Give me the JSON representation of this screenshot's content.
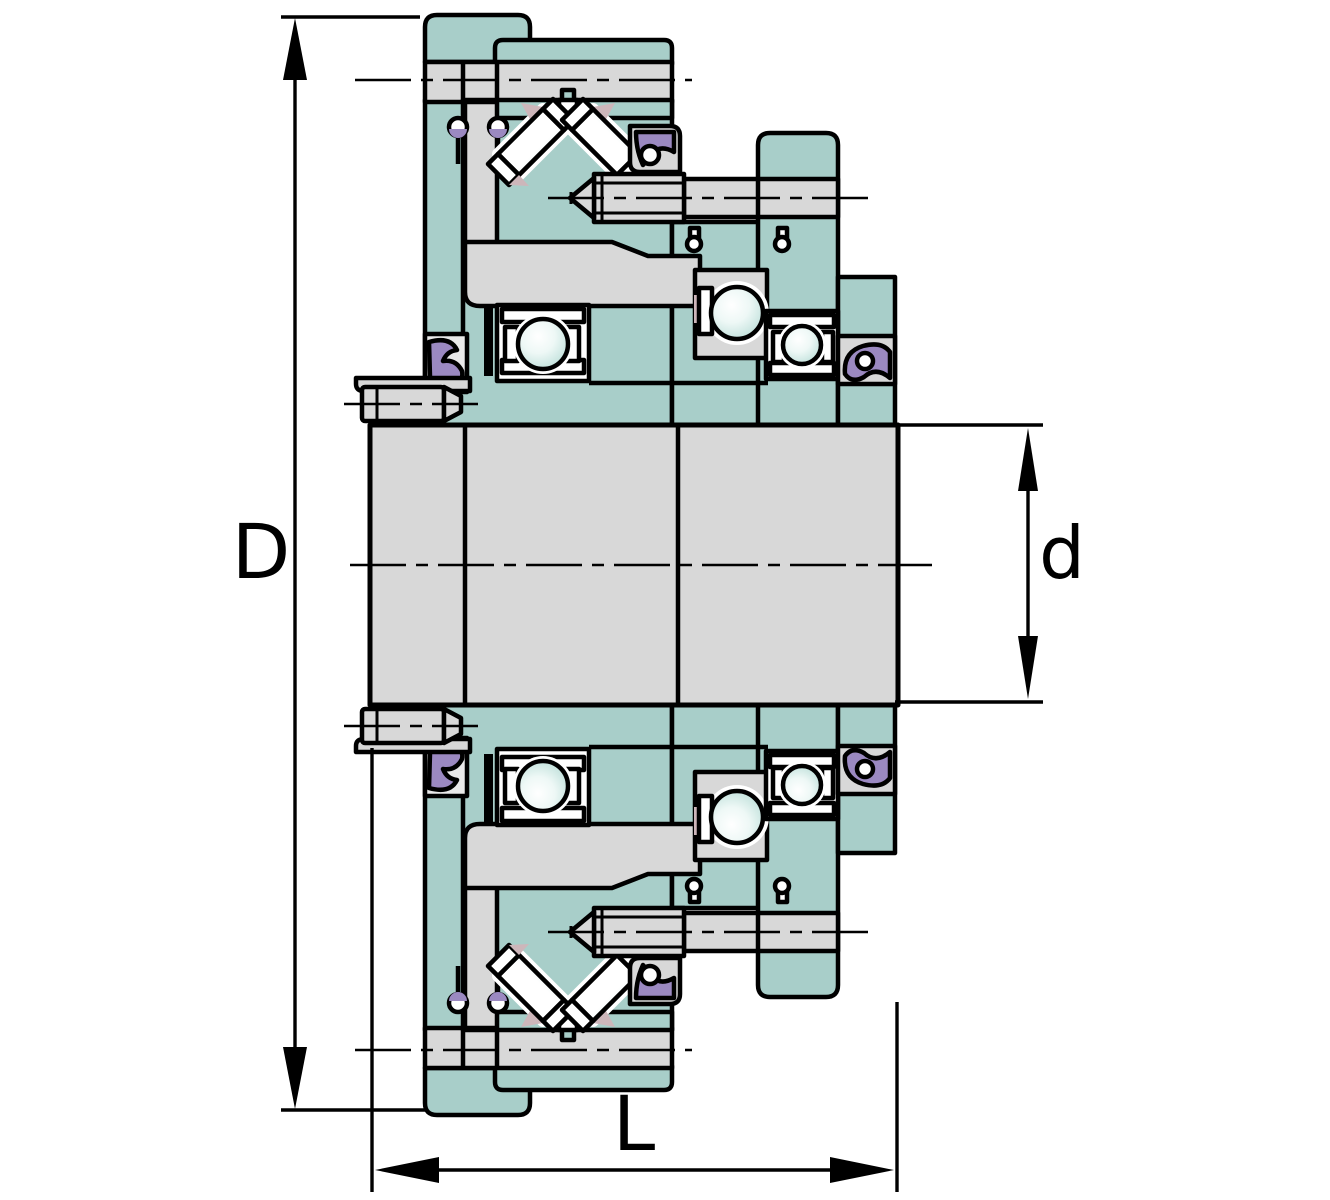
{
  "figure": {
    "kind": "engineering-cross-section-diagram",
    "subject": "flanged bearing unit cross-section",
    "background": "#ffffff"
  },
  "dimension_labels": {
    "outer_diameter": "D",
    "bore_diameter": "d",
    "width": "L"
  },
  "palette": {
    "housing_teal": "#a8cec9",
    "metal_gray": "#d8d8d8",
    "pocket_gray": "#e9e9e9",
    "seal_purple": "#9b89c1",
    "cage_pink": "#cdb6ba",
    "ball_tint": "#bfe0da",
    "outline": "#000000"
  },
  "components": [
    "housing",
    "mounting-flange",
    "shaft",
    "v-arranged-rollers",
    "ball-bearing",
    "seal",
    "locking-bolt",
    "grease-screw",
    "rivet",
    "centerline",
    "dimension-arrow"
  ]
}
